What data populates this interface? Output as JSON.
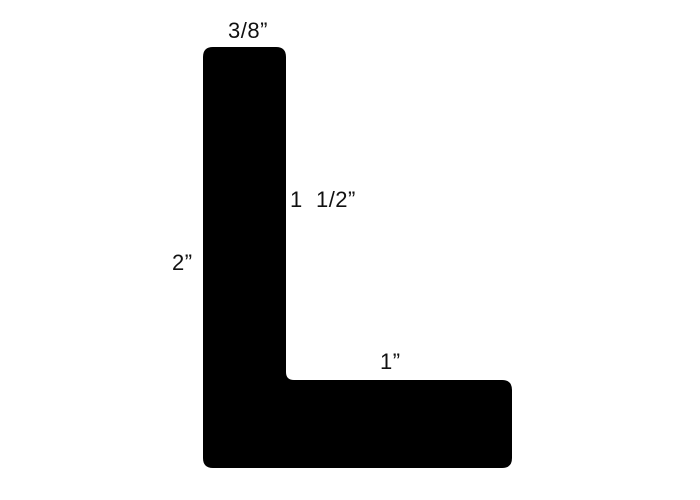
{
  "shape": {
    "name": "L-profile cross-section",
    "fill": "#000000"
  },
  "dimensions": {
    "top_width": "3/8”",
    "inner_height": "1  1/2”",
    "left_height": "2”",
    "bottom_width": "1”"
  }
}
